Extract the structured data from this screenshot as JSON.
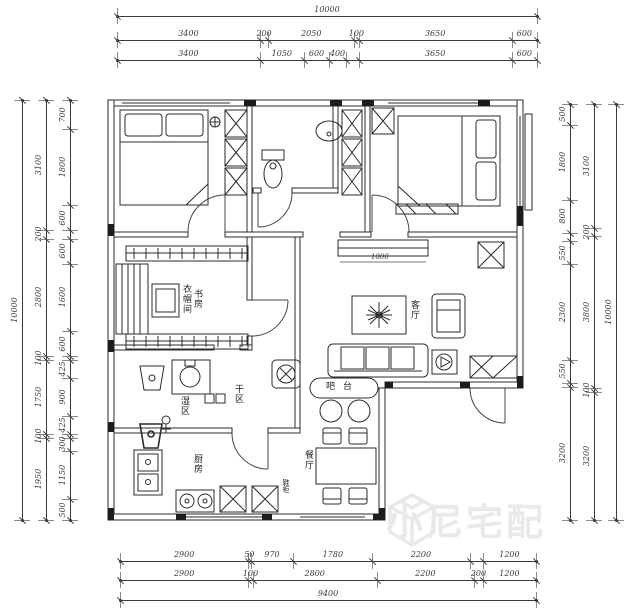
{
  "dimensions": {
    "top": [
      [
        "10000"
      ],
      [
        "3400",
        "200",
        "2050",
        "100",
        "3650",
        "600"
      ],
      [
        "3400",
        "1050",
        "600",
        "400",
        "3650",
        "600"
      ]
    ],
    "bottom": [
      [
        "2900",
        "50",
        "970",
        "1780",
        "2200",
        "1200"
      ],
      [
        "2900",
        "100",
        "2800",
        "2200",
        "200",
        "1200"
      ],
      [
        "9400"
      ]
    ],
    "left": [
      [
        "10000"
      ],
      [
        "3100",
        "200",
        "2800",
        "100",
        "1750",
        "100",
        "1950"
      ],
      [
        "700",
        "1800",
        "600",
        "600",
        "1600",
        "600",
        "425",
        "900",
        "425",
        "300",
        "1150",
        "500"
      ]
    ],
    "right": [
      [
        "500",
        "1800",
        "800",
        "550",
        "2300",
        "550",
        "3200"
      ],
      [
        "3100",
        "200",
        "3800",
        "100",
        "3200"
      ],
      [
        "10000"
      ]
    ]
  },
  "internal_dims": {
    "tv_wall": "1800"
  },
  "rooms": {
    "cloakroom": "衣帽间",
    "study": "书房",
    "wet_area": "湿区",
    "dry_area": "干区",
    "kitchen": "厨房",
    "living_room": "客厅",
    "bar": "吧台",
    "dining_room": "餐厅",
    "shoe_cabinet": "鞋柜"
  },
  "watermark": {
    "text": "小尼宅配"
  },
  "colors": {
    "line": "#2b2b2b",
    "dim_text": "#3a3a3a",
    "watermark": "#e9e9e9"
  }
}
